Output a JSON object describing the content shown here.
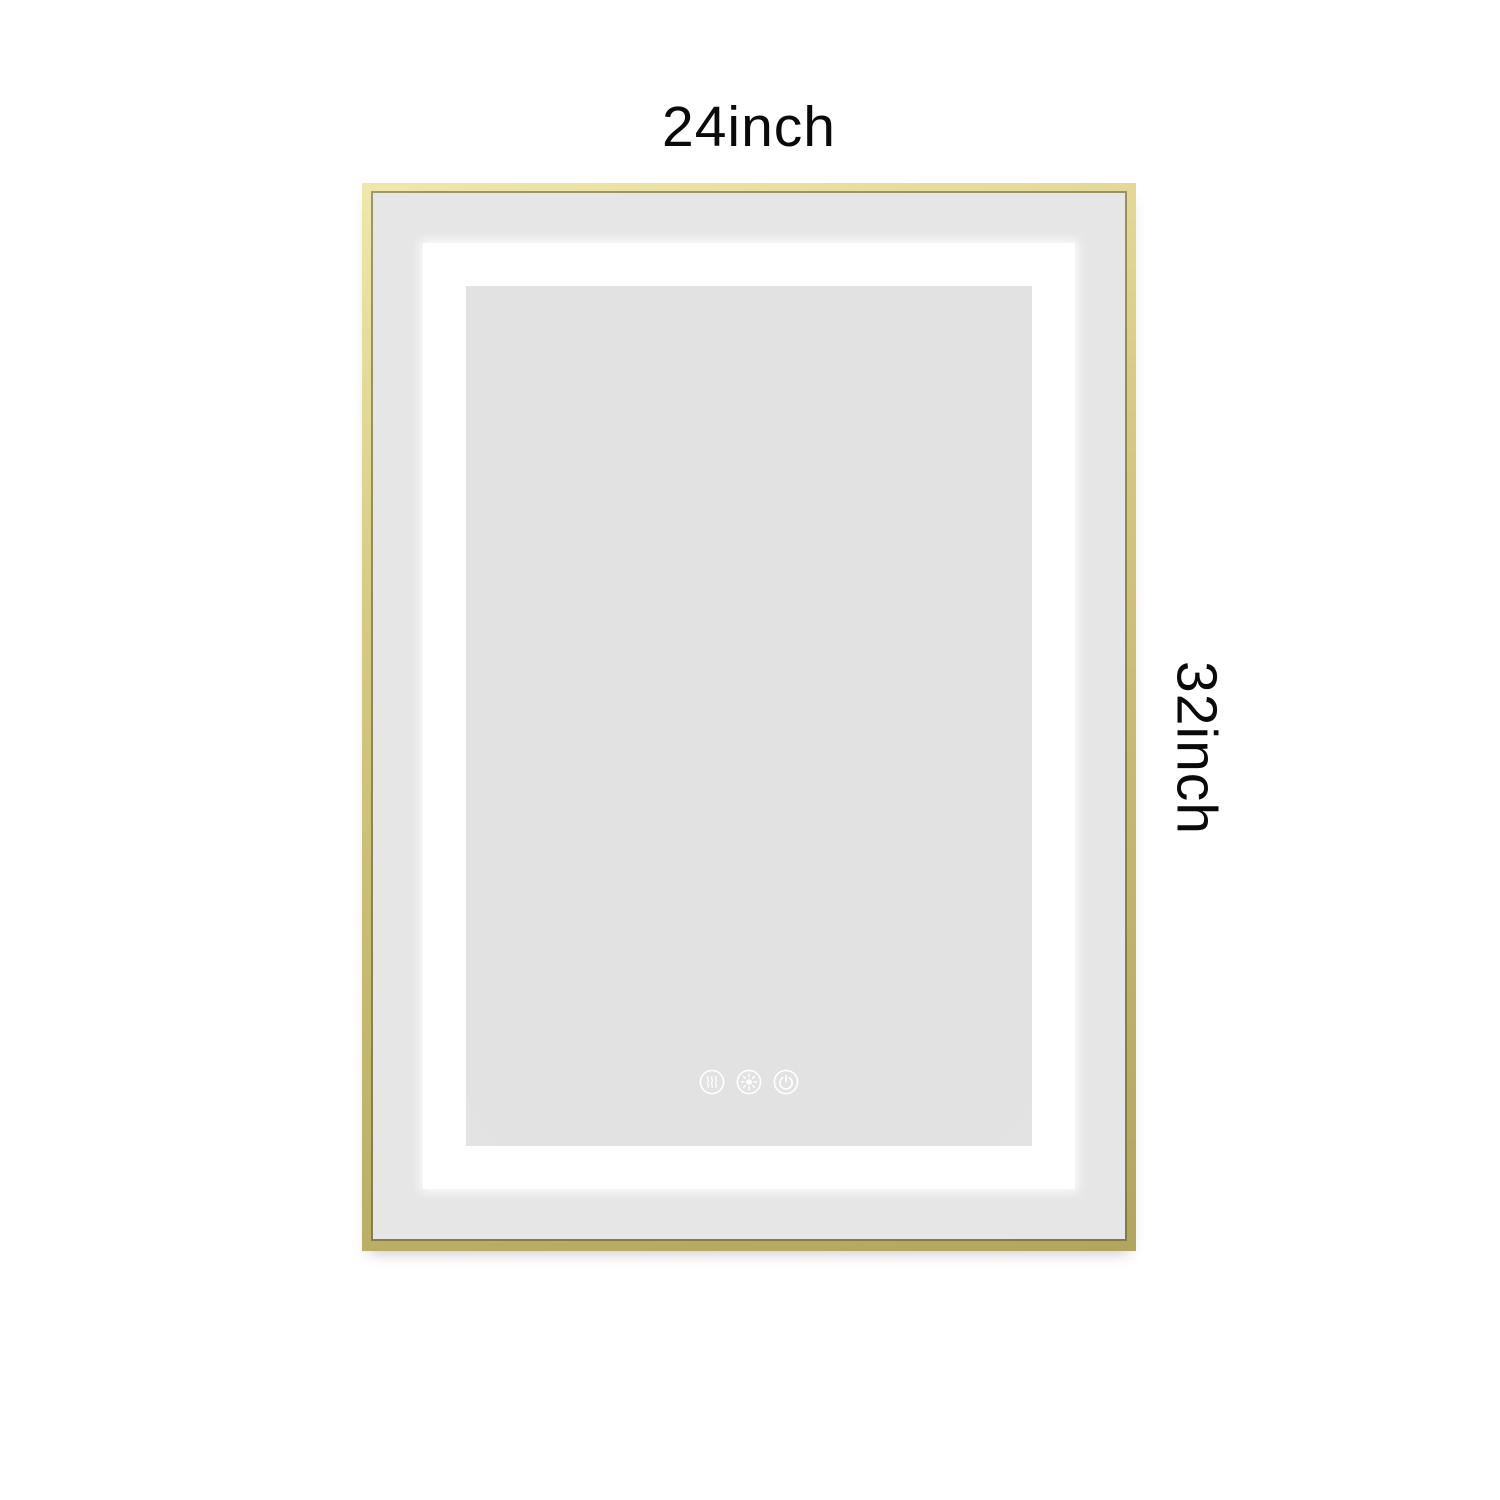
{
  "product": {
    "name": "led-bathroom-mirror",
    "width_label": "24inch",
    "height_label": "32inch"
  },
  "controls": [
    {
      "label": "defog",
      "icon": "defog-icon"
    },
    {
      "label": "brightness",
      "icon": "brightness-icon"
    },
    {
      "label": "power",
      "icon": "power-icon"
    }
  ],
  "colors": {
    "bg": "#ffffff",
    "label": "#0a0a0a",
    "gold": "#d6c981",
    "gold-light": "#efe7ab",
    "gold-dark": "#b2a65e",
    "mirror-border": "#e6e6e6",
    "led": "#ffffff",
    "mirror": "#e2e2e2",
    "icon": "#ffffff"
  }
}
